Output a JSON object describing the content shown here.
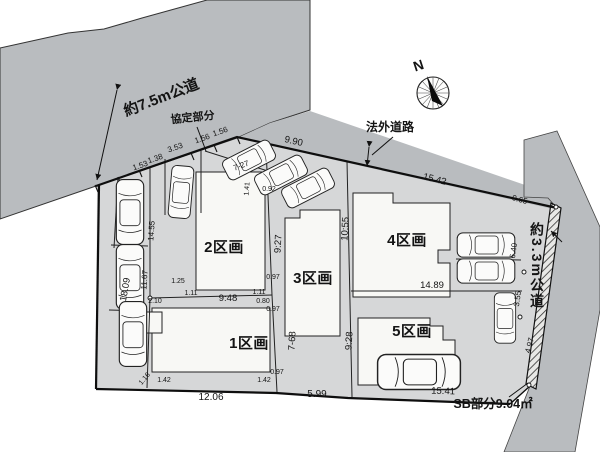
{
  "diagram": {
    "north_label": "N",
    "roads": {
      "top_road": "約7.5m公道",
      "agreement_section": "協定部分",
      "unofficial_road": "法外道路",
      "right_road": "約3.3m公道",
      "sb_section": "SB部分9.04㎡"
    },
    "lots": [
      {
        "label": "1区画"
      },
      {
        "label": "2区画"
      },
      {
        "label": "3区画"
      },
      {
        "label": "4区画"
      },
      {
        "label": "5区画"
      }
    ],
    "dims": [
      {
        "t": "1.53"
      },
      {
        "t": "1.38"
      },
      {
        "t": "3.53"
      },
      {
        "t": "1.56"
      },
      {
        "t": "1.56"
      },
      {
        "t": "9.90"
      },
      {
        "t": "15.42"
      },
      {
        "t": "0.65"
      },
      {
        "t": "18.09"
      },
      {
        "t": "14:55"
      },
      {
        "t": "11.67"
      },
      {
        "t": "2.10"
      },
      {
        "t": "1.25"
      },
      {
        "t": "1.11"
      },
      {
        "t": "9:48"
      },
      {
        "t": "1.11"
      },
      {
        "t": "0.80"
      },
      {
        "t": "7-27"
      },
      {
        "t": "1.41"
      },
      {
        "t": "0.92"
      },
      {
        "t": "9:27"
      },
      {
        "t": "0.97"
      },
      {
        "t": "0.97"
      },
      {
        "t": "0.97"
      },
      {
        "t": "7-68"
      },
      {
        "t": "10:55"
      },
      {
        "t": "9:28"
      },
      {
        "t": "5.99"
      },
      {
        "t": "12.06"
      },
      {
        "t": "1.16"
      },
      {
        "t": "1.42"
      },
      {
        "t": "1.42"
      },
      {
        "t": "15.41"
      },
      {
        "t": "14.89"
      },
      {
        "t": "6.40"
      },
      {
        "t": "3.55"
      },
      {
        "t": "4.97"
      }
    ]
  }
}
